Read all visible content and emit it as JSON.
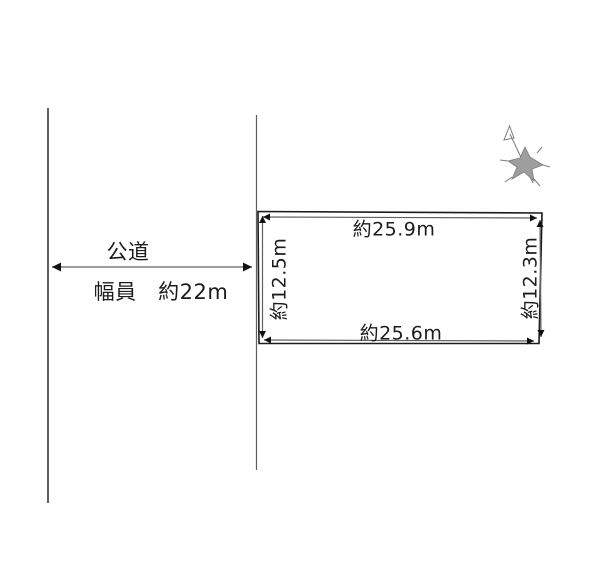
{
  "canvas": {
    "width": 600,
    "height": 575,
    "background": "#ffffff"
  },
  "colors": {
    "canvas_bg": "#ffffff",
    "line": "#1c1c1c",
    "dim_line": "#5f5f5f",
    "arrow": "#111111",
    "compass_fill": "#9e9e9e",
    "compass_stroke": "#7d7d7d"
  },
  "road": {
    "name": "公道",
    "width_text": "幅員　約22m"
  },
  "plot": {
    "top_dimension": "約25.9m",
    "bottom_dimension": "約25.6m",
    "left_dimension": "約12.5m",
    "right_dimension": "約12.3m"
  },
  "icons": {
    "compass": "north-arrow"
  }
}
